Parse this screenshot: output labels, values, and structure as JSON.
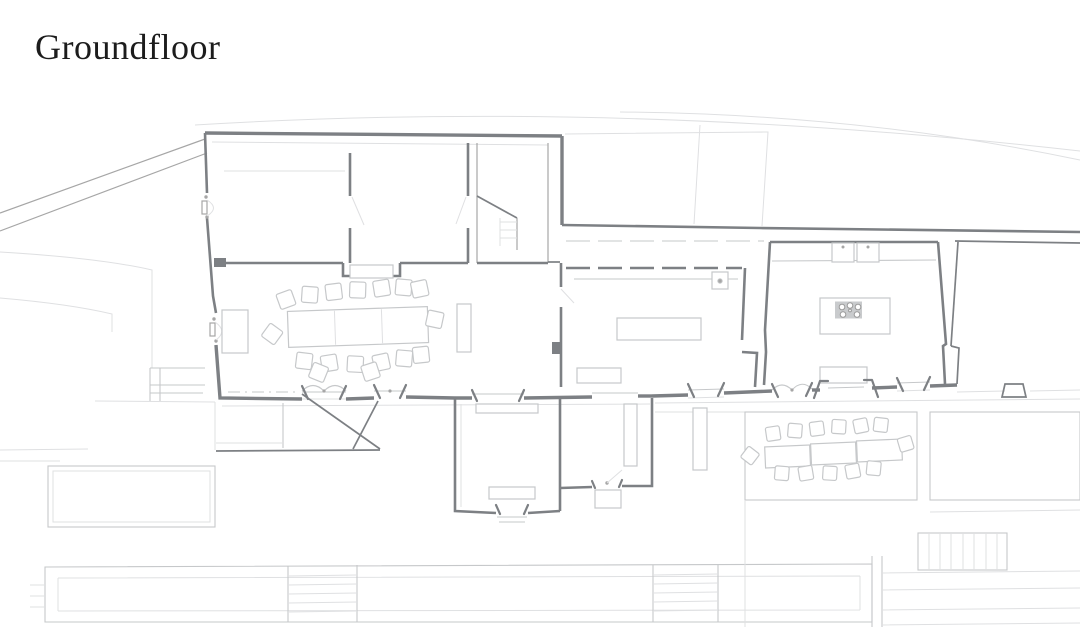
{
  "header": {
    "title": "Groundfloor"
  },
  "colors": {
    "background": "#ffffff",
    "ink": "#1c1c1c",
    "wall": "#7d8084",
    "mid": "#a6a6a6",
    "light": "#c6c8ca",
    "xlight": "#dfe0e2"
  }
}
